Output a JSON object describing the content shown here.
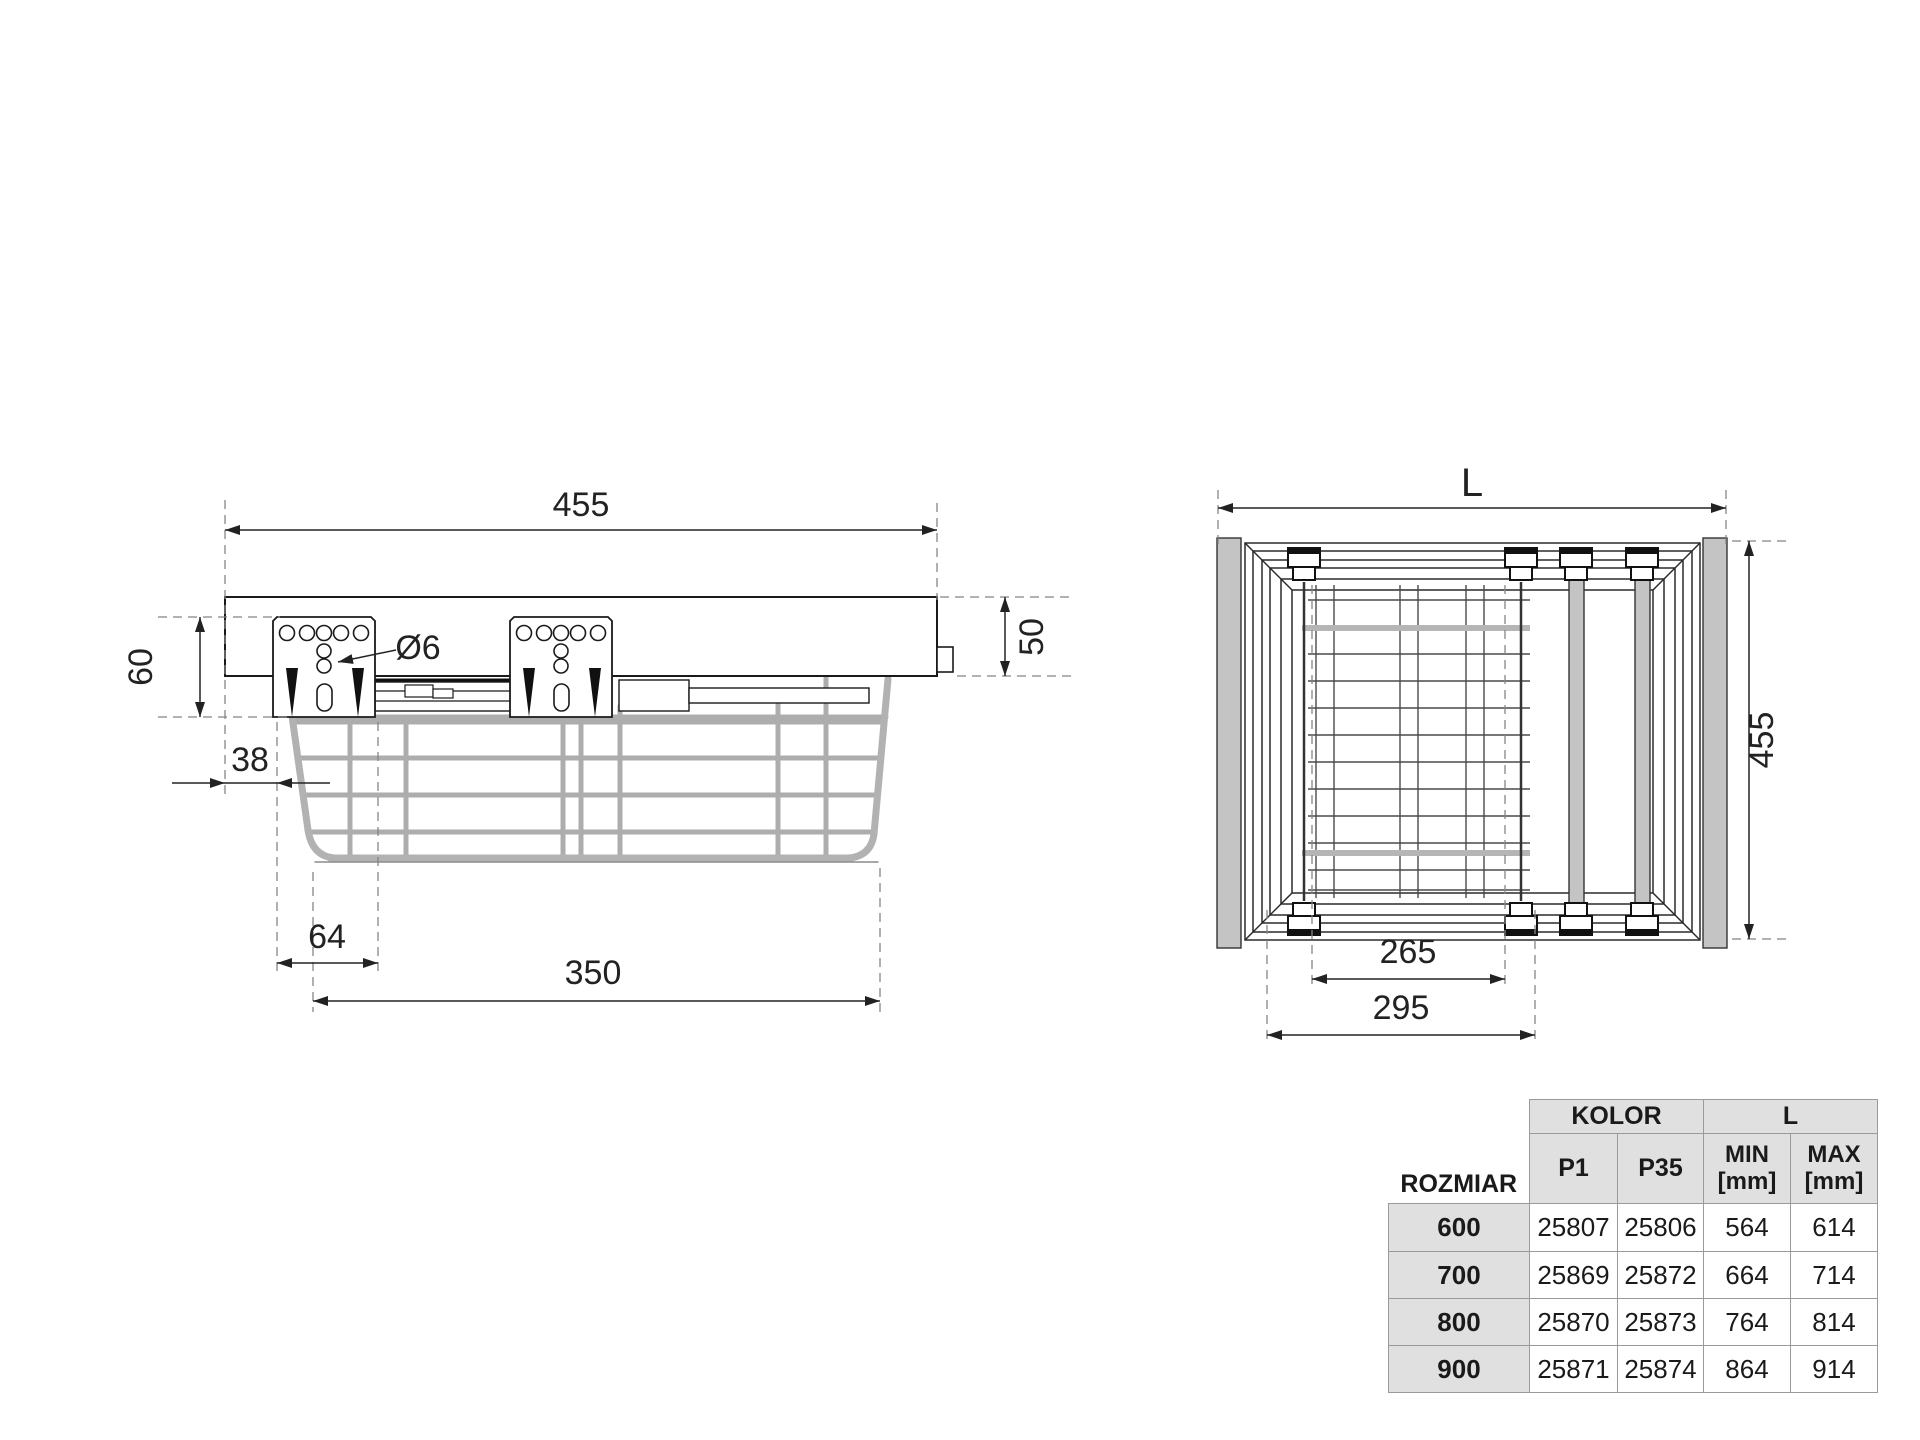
{
  "side_view": {
    "labels": {
      "width": "455",
      "left_height": "60",
      "right_height": "50",
      "hole_dia": "Ø6",
      "front_offset": "38",
      "bracket_width": "64",
      "basket_bottom": "350"
    }
  },
  "top_view": {
    "labels": {
      "length": "L",
      "depth": "455",
      "inner_width": "265",
      "outer_width": "295"
    }
  },
  "table": {
    "headers": {
      "rozmiar": "ROZMIAR",
      "kolor": "KOLOR",
      "l": "L",
      "p1": "P1",
      "p35": "P35",
      "min_line1": "MIN",
      "min_line2": "[mm]",
      "max_line1": "MAX",
      "max_line2": "[mm]"
    },
    "rows": [
      {
        "size": "600",
        "p1": "25807",
        "p35": "25806",
        "min": "564",
        "max": "614"
      },
      {
        "size": "700",
        "p1": "25869",
        "p35": "25872",
        "min": "664",
        "max": "714"
      },
      {
        "size": "800",
        "p1": "25870",
        "p35": "25873",
        "min": "764",
        "max": "814"
      },
      {
        "size": "900",
        "p1": "25871",
        "p35": "25874",
        "min": "864",
        "max": "914"
      }
    ]
  },
  "colors": {
    "line": "#1a1a1a",
    "dimension": "#222222",
    "grey_fill": "#c4c4c4",
    "wire_grey": "#adadad",
    "table_cell_grey": "#e0e0e0",
    "table_border": "#9a9a9a",
    "background": "#ffffff"
  }
}
